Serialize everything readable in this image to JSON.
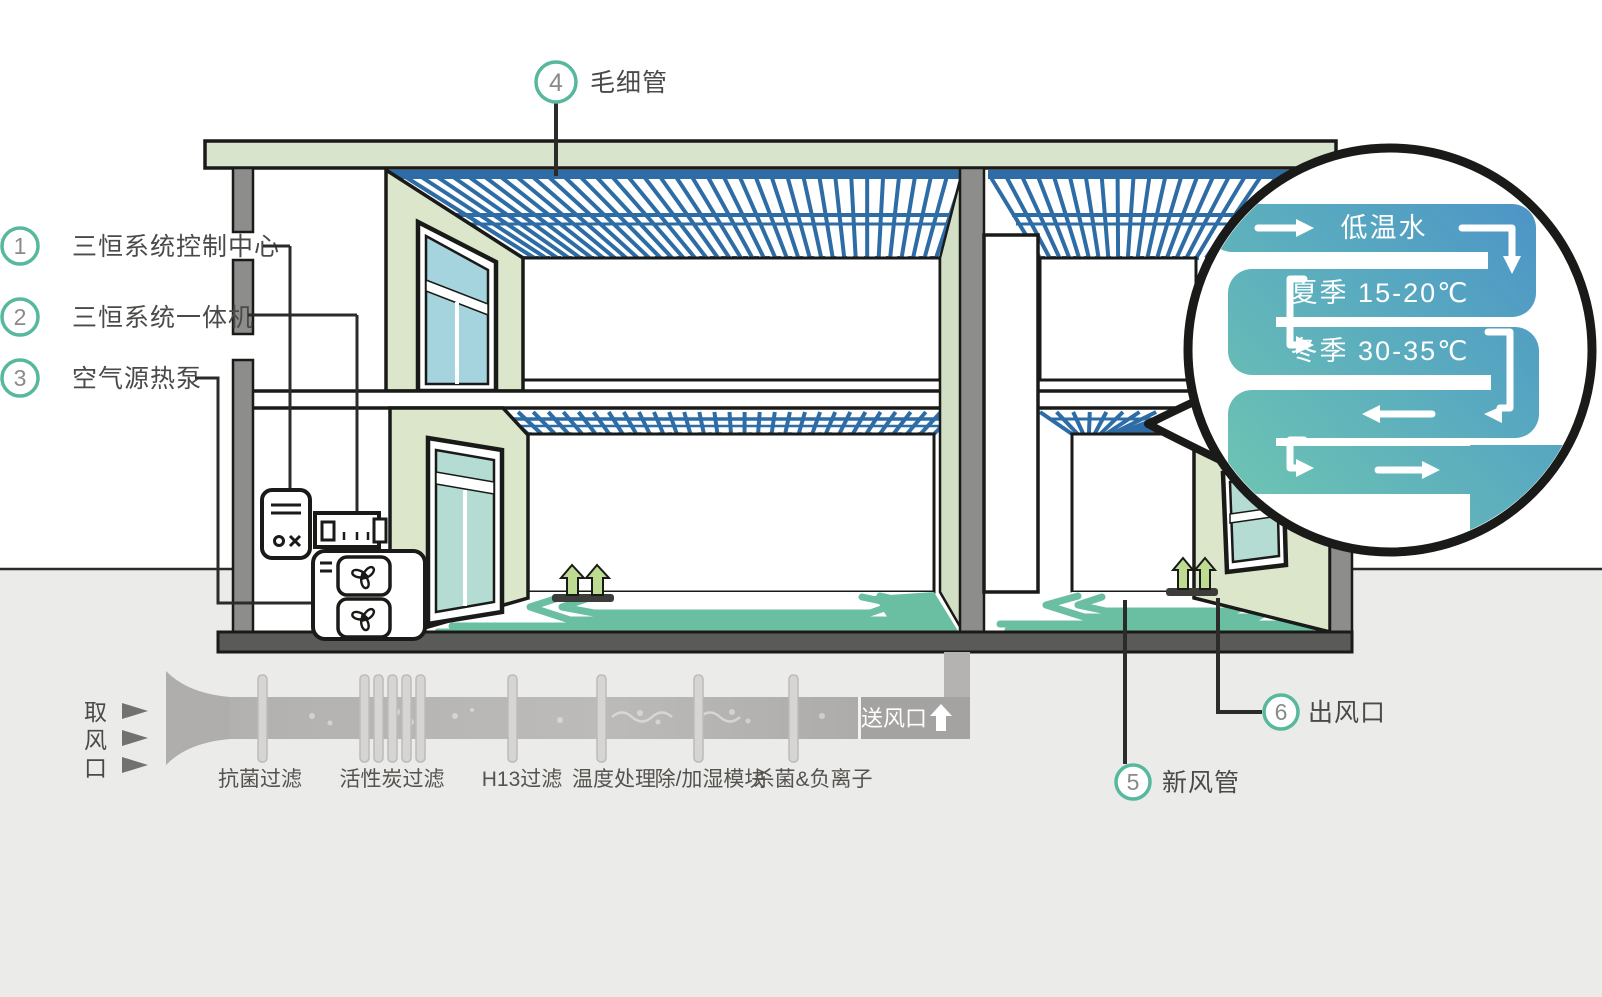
{
  "legend": {
    "items": [
      {
        "num": "1",
        "label": "三恒系统控制中心"
      },
      {
        "num": "2",
        "label": "三恒系统一体机"
      },
      {
        "num": "3",
        "label": "空气源热泵"
      }
    ]
  },
  "callouts": {
    "capillary": {
      "num": "4",
      "label": "毛细管"
    },
    "fresh_air_duct": {
      "num": "5",
      "label": "新风管"
    },
    "air_outlet": {
      "num": "6",
      "label": "出风口"
    }
  },
  "bubble": {
    "line1": "低温水",
    "line2": "夏季 15-20℃",
    "line3": "冬季 30-35℃"
  },
  "pipeline": {
    "intake": {
      "char1": "取",
      "char2": "风",
      "char3": "口"
    },
    "stages": [
      "抗菌过滤",
      "活性炭过滤",
      "H13过滤",
      "温度处理",
      "除/加湿模块",
      "杀菌&负离子"
    ],
    "outlet": "送风口"
  },
  "colors": {
    "accent_teal_ring": "#57b89d",
    "capillary_blue": "#2e6ca6",
    "coil_teal": "#6abfa3",
    "wall_sage": "#dbe6cb",
    "bubble_blue": "#4a90c8",
    "bubble_teal": "#68c3b0",
    "ground_gray": "#ebebe9"
  }
}
